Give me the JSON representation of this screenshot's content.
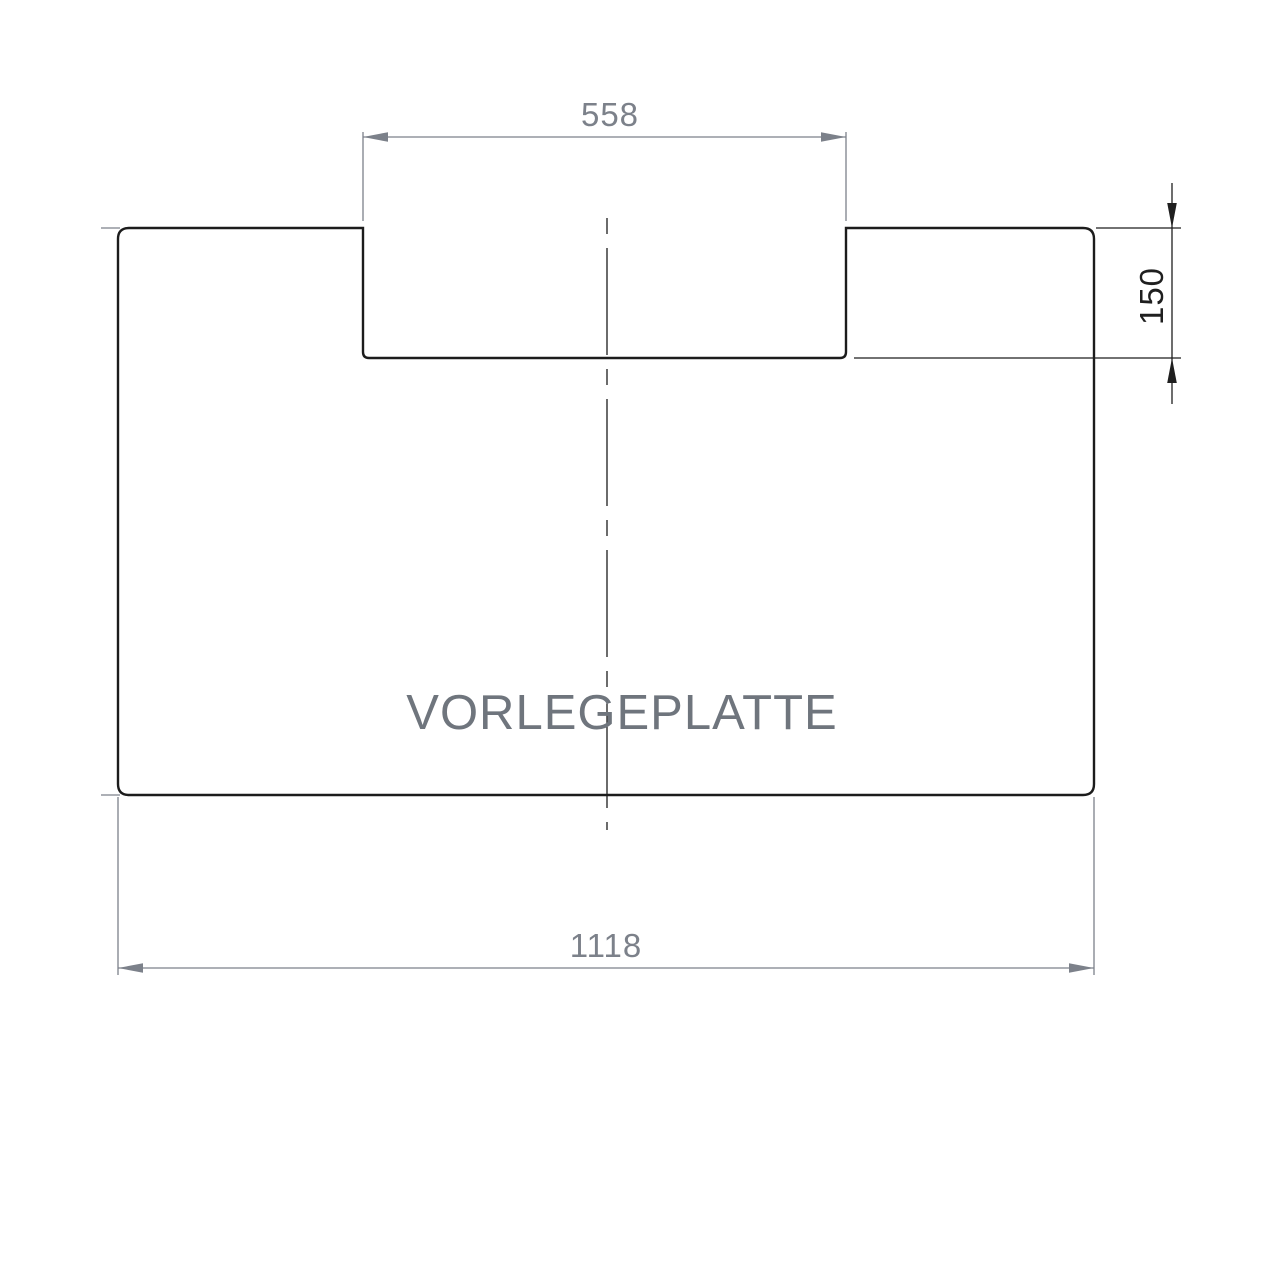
{
  "drawing": {
    "title": "VORLEGEPLATTE",
    "dimensions": {
      "top_width": "558",
      "right_depth": "150",
      "bottom_width": "1118"
    },
    "colors": {
      "outline": "#1c1c1c",
      "dimension_gray": "#7c818a",
      "dimension_dark": "#1f1f1f",
      "title_gray": "#6f757d",
      "background": "#ffffff"
    }
  }
}
